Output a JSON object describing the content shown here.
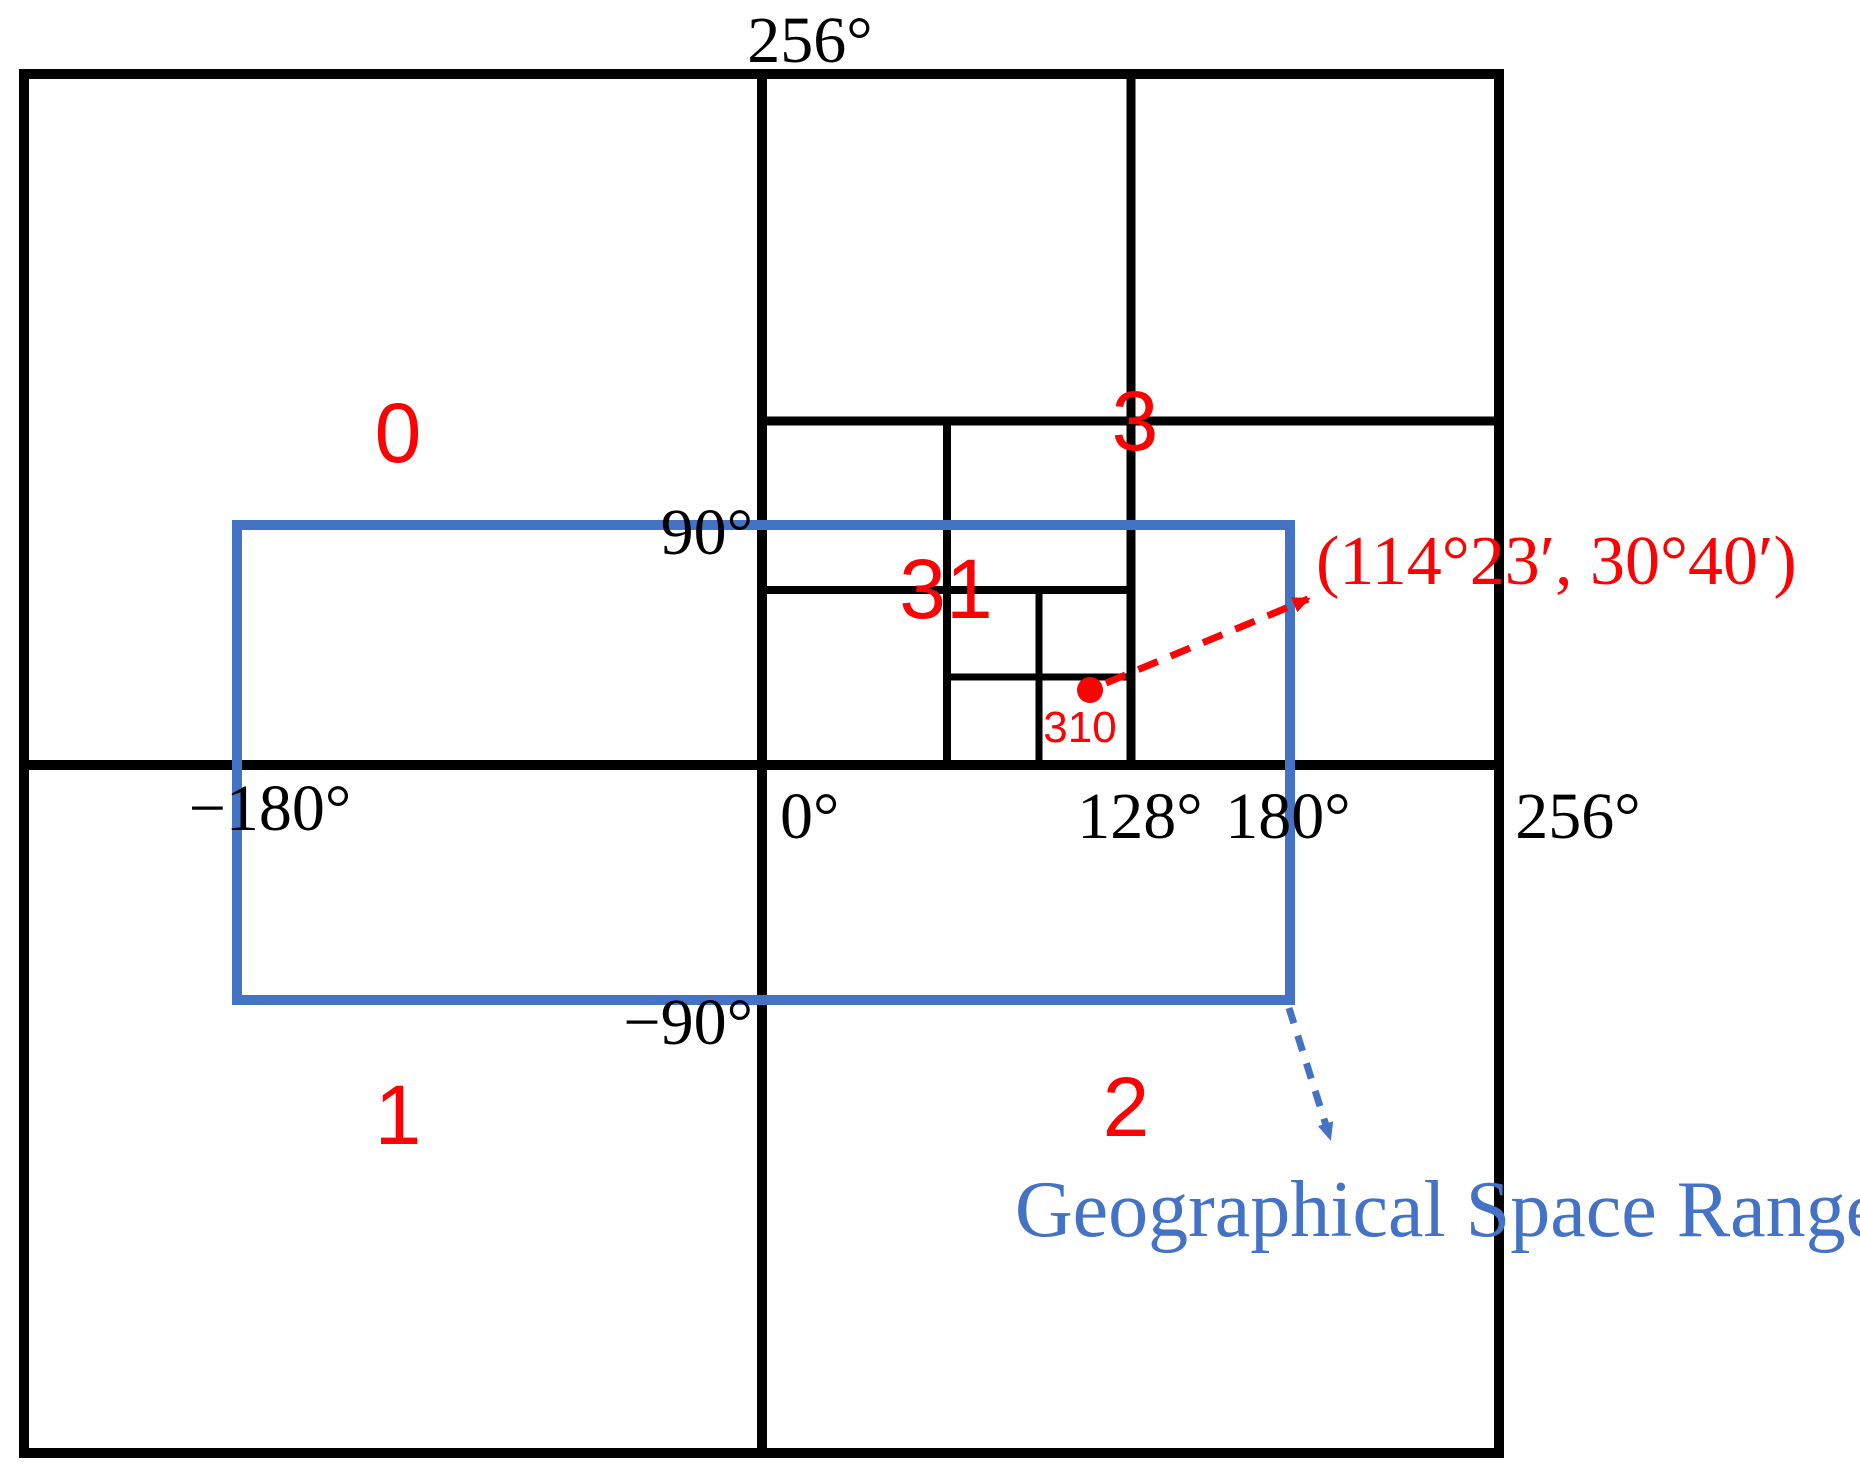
{
  "figure": {
    "title_hint": "Quadtree geographical space encoding diagram",
    "colors": {
      "line_black": "#000000",
      "accent_blue": "#4472C4",
      "accent_red": "#FB0304",
      "background": "#ffffff"
    },
    "axis": {
      "top_256": "256°",
      "lat_90": "90°",
      "lon_neg180": "−180°",
      "lon_0": "0°",
      "lon_128": "128°",
      "lon_180": "180°",
      "lon_256": "256°",
      "lat_neg90": "−90°"
    },
    "quadrants": {
      "q0": "0",
      "q1": "1",
      "q2": "2",
      "q3": "3",
      "q31": "31",
      "q310": "310"
    },
    "point": {
      "coordinates_label": "(114°23′, 30°40′)"
    },
    "range": {
      "label": "Geographical Space Range"
    }
  }
}
